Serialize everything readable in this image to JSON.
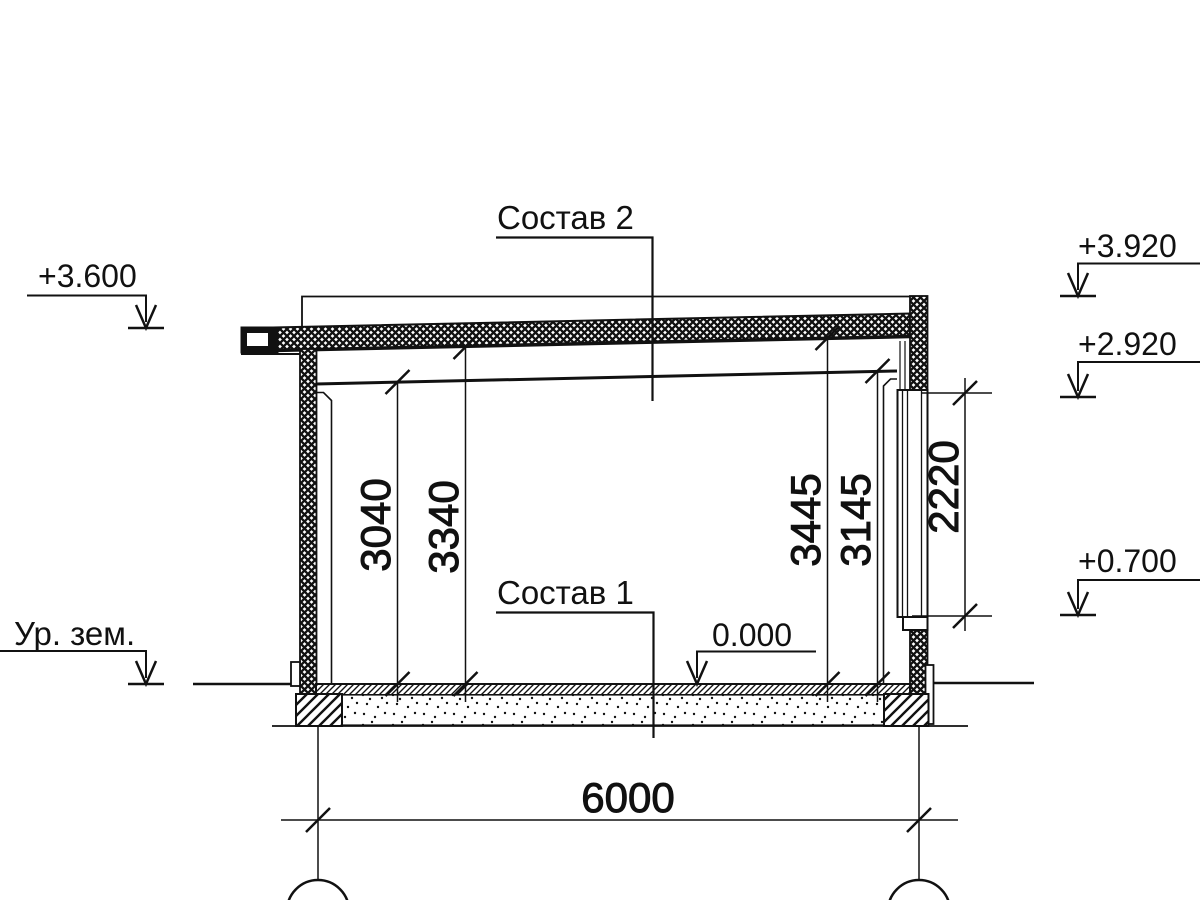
{
  "drawing": {
    "type": "architectural-section",
    "colors": {
      "ink": "#111111",
      "background": "#ffffff"
    },
    "callouts": {
      "roof_composition": "Состав 2",
      "floor_composition": "Состав 1"
    },
    "elevation_marks": {
      "roof_eave": "+3.600",
      "ground_level_label": "Ур. зем.",
      "parapet_top": "+3.920",
      "window_head": "+2.920",
      "window_sill": "+0.700",
      "floor_level": "0.000"
    },
    "dimensions": {
      "bay_width": "6000",
      "ceiling_height_left": "3040",
      "roof_underside_left": "3340",
      "roof_underside_right": "3445",
      "ceiling_height_right": "3145",
      "window_height": "2220"
    }
  }
}
